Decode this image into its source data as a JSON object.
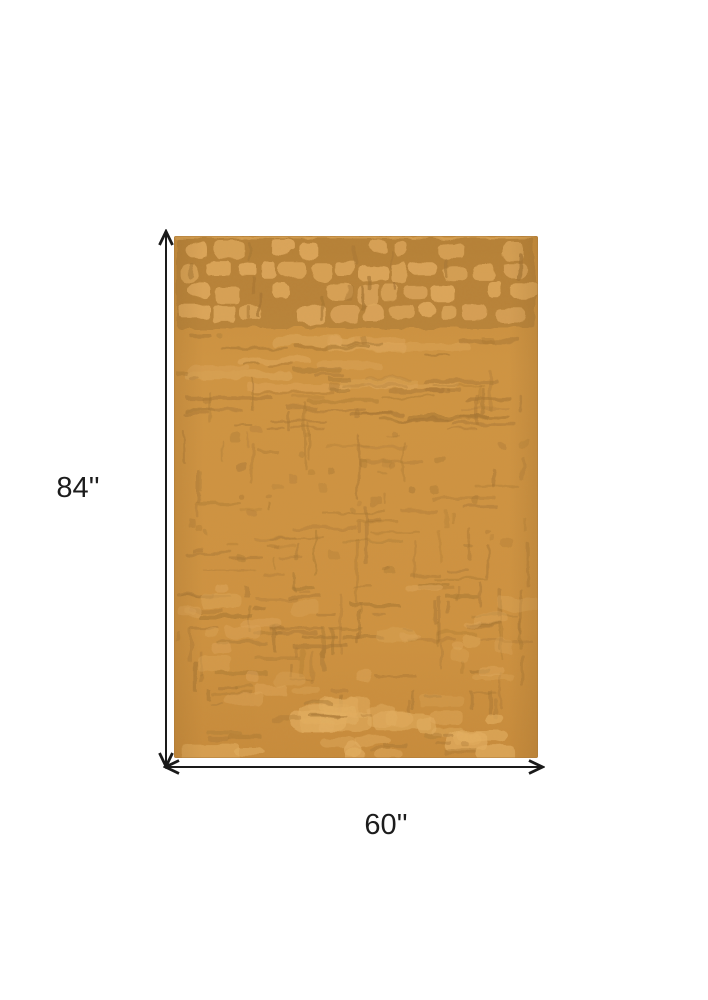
{
  "figure": {
    "height_label": "84''",
    "width_label": "60''",
    "colors": {
      "background": "#ffffff",
      "dimension_line": "#1a1a1a",
      "rug_base": "#CE9140",
      "rug_base_deep": "#C4873A",
      "rug_dark": "#A57432",
      "rug_light": "#DFA85C",
      "rug_light_bright": "#E5B062"
    }
  }
}
